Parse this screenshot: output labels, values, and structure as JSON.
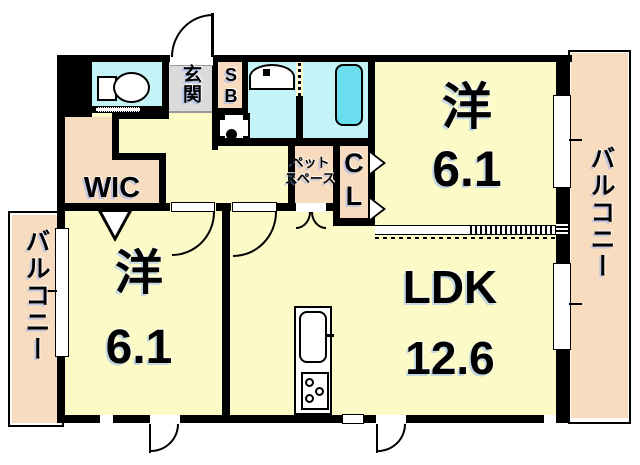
{
  "plan": {
    "bedroom_top": {
      "kanji": "洋",
      "size": "6.1"
    },
    "bedroom_bottom": {
      "kanji": "洋",
      "size": "6.1"
    },
    "ldk": {
      "kanji": "LDK",
      "size": "12.6"
    },
    "wic_label": "WIC",
    "entrance_label": "玄関",
    "shoebox_label": "SB",
    "closet_label": "CL",
    "pet_space": {
      "line1": "ペット",
      "line2": "スペース"
    },
    "balcony_left_label": "バルコニー",
    "balcony_right_label": "バルコニー",
    "colors": {
      "room_yellow": "#FCFBC8",
      "balcony_peach": "#F8DCBF",
      "wet_area_cyan": "#C4F4F7",
      "bathtub_cyan": "#6ADEEF",
      "entrance_gray": "#DBDBDB",
      "wall_black": "#000000"
    }
  }
}
